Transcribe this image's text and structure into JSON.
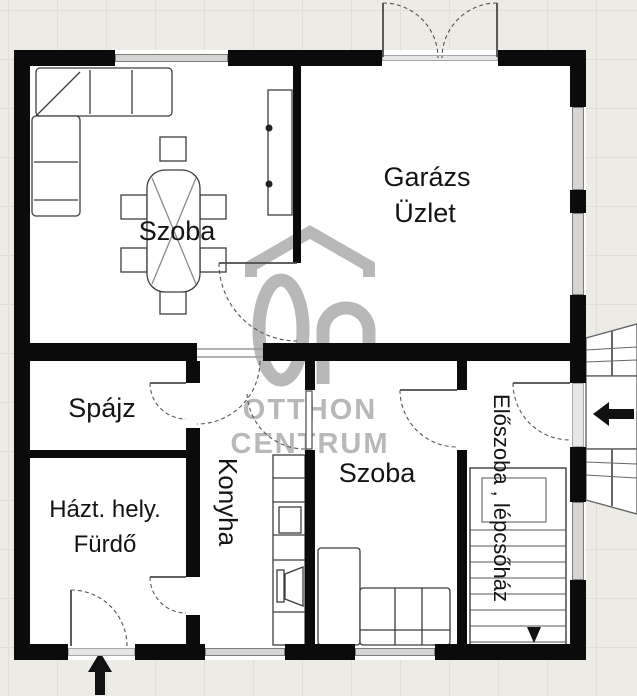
{
  "plan": {
    "title": "floor-plan",
    "rooms": {
      "szoba_top": "Szoba",
      "garazs_line1": "Garázs",
      "garazs_line2": "Üzlet",
      "spajz": "Spájz",
      "haztartasi_line1": "Házt. hely.",
      "haztartasi_line2": "Fürdő",
      "konyha": "Konyha",
      "szoba_bottom": "Szoba",
      "eloszoba": "Előszoba , lépcsőház"
    },
    "watermark": {
      "line1": "OTTHON",
      "line2": "CENTRUM"
    },
    "colors": {
      "wall": "#0b0b0b",
      "watermark_gray": "#a9a9a9",
      "background": "#edebe6",
      "floor": "#ffffff",
      "window_fill": "#d6d5d4",
      "label_text": "#141414"
    }
  }
}
